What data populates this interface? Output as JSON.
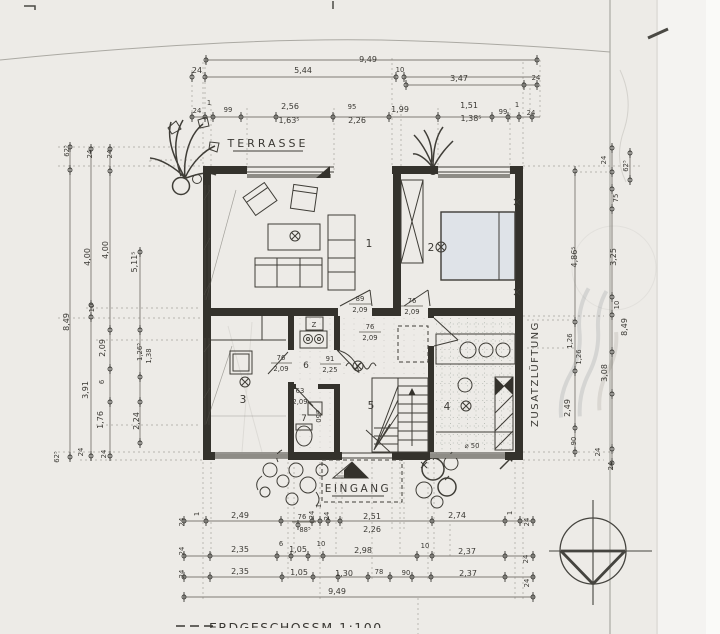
{
  "labels": {
    "terrasse": "TERRASSE",
    "eingang": "EINGANG",
    "zusatzlueftung": "ZUSATZLÜFTUNG",
    "flue": "Z",
    "scale_line": "ERDGESCHOSS",
    "scale_ratio": "M 1:100"
  },
  "rooms": {
    "r1": "1",
    "r2": "2",
    "r3": "3",
    "r4": "4",
    "r5": "5",
    "r6": "6",
    "r7": "7"
  },
  "doors": {
    "living": {
      "w": "89",
      "h": "2,09"
    },
    "bedroom": {
      "w": "76",
      "h": "2,09"
    },
    "bath": {
      "w": "76",
      "h": "2,09"
    },
    "kitchen": {
      "w": "91",
      "h": "2,25"
    },
    "room3": {
      "w": "76",
      "h": "2,09"
    },
    "wc": {
      "w": "63",
      "h": "2,09"
    }
  },
  "notes": {
    "bath_drain": "⌀ 50",
    "wc_drain": "⌀50"
  },
  "dims": {
    "top": [
      "9,49",
      "24",
      "5,44",
      "10",
      "3,47",
      "24",
      "24",
      "1",
      "99",
      "2,56",
      "1,63⁵",
      "95",
      "2,26",
      "1,99",
      "1,51",
      "1,38⁵",
      "99",
      "1",
      "24"
    ],
    "left": [
      "62⁵",
      "8,49",
      "24",
      "4,00",
      "10",
      "3,91",
      "24",
      "24",
      "4,00",
      "2,09",
      "6",
      "1,76",
      "24",
      "5,11⁵",
      "1,26⁵",
      "1,38",
      "2,24",
      "62⁵"
    ],
    "right": [
      "24",
      "62⁵",
      "75",
      "4,86⁵",
      "3,25",
      "10",
      "8,49",
      "1,26",
      "1,26",
      "3,08",
      "2,49",
      "90",
      "24",
      "24"
    ],
    "bottom": [
      "24",
      "1",
      "2,49",
      "76",
      "88⁵",
      "1",
      "24",
      "24",
      "2,51",
      "2,26",
      "2,74",
      "1",
      "24",
      "24",
      "2,35",
      "6",
      "1,05",
      "10",
      "2,98",
      "10",
      "2,37",
      "24",
      "24",
      "2,35",
      "1,05",
      "1,30",
      "78",
      "90",
      "2,37",
      "24",
      "9,49"
    ]
  }
}
